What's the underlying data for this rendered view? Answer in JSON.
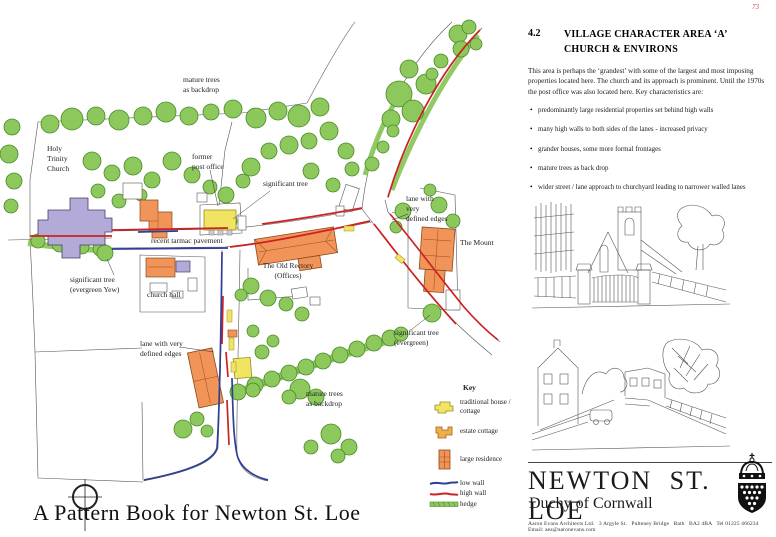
{
  "page_number": "73",
  "map": {
    "bottom_title": "A Pattern Book for Newton St. Loe",
    "labels": [
      {
        "text": "mature trees\nas backdrop"
      },
      {
        "text": "Holy\nTrinity\nChurch"
      },
      {
        "text": "former\npost office"
      },
      {
        "text": "significant tree"
      },
      {
        "text": "recent tarmac pavement"
      },
      {
        "text": "significant tree\n(evergreen Yew)"
      },
      {
        "text": "church hall"
      },
      {
        "text": "lane with\nvery\ndefined edges"
      },
      {
        "text": "The Mount"
      },
      {
        "text": "The Old Rectory\n(Offices)"
      },
      {
        "text": "significant tree\n(evergreen)"
      },
      {
        "text": "lane with very\ndefined edges"
      },
      {
        "text": "mature trees\nas backdrop"
      }
    ],
    "key": {
      "title": "Key",
      "items": [
        {
          "label": "traditional house /\ncottage"
        },
        {
          "label": "estate cottage"
        },
        {
          "label": "large residence"
        },
        {
          "label": "low wall"
        },
        {
          "label": "high wall"
        },
        {
          "label": "hedge"
        }
      ]
    }
  },
  "panel": {
    "section_number": "4.2",
    "title_line1": "VILLAGE CHARACTER AREA  ‘A’",
    "title_line2": "CHURCH & ENVIRONS",
    "intro": "This area is perhaps the ‘grandest’ with some of the largest and most imposing properties located here. The church and its approach is prominent. Until the 1970s the post office was also located here. Key characteristics are:",
    "bullet": "•",
    "bullets": [
      "predominantly large residential properties set behind high walls",
      "many high walls to both sides of the lanes - increased privacy",
      "grander houses, some more formal frontages",
      "mature trees as back drop",
      "wider street / lane approach to churchyard leading to narrower walled lanes",
      "the church defines the north-west extremity of village"
    ]
  },
  "brand": {
    "name": "NEWTON ST. LOE",
    "subtitle": "Duchy of Cornwall",
    "footer": "Aaron Evans Architects Ltd.   3 Argyle St.   Pulteney Bridge   Bath   BA2 4BA   Tel 01225 466234   Email: aea@aaronevans.com"
  },
  "colors": {
    "tree_green": "#8cc85c",
    "church_purple": "#b4aad8",
    "traditional_yellow": "#f2e463",
    "estate_amber": "#eeb04a",
    "residence_orange": "#f0945a",
    "low_wall_blue": "#2f3f96",
    "high_wall_red": "#cc2222"
  }
}
